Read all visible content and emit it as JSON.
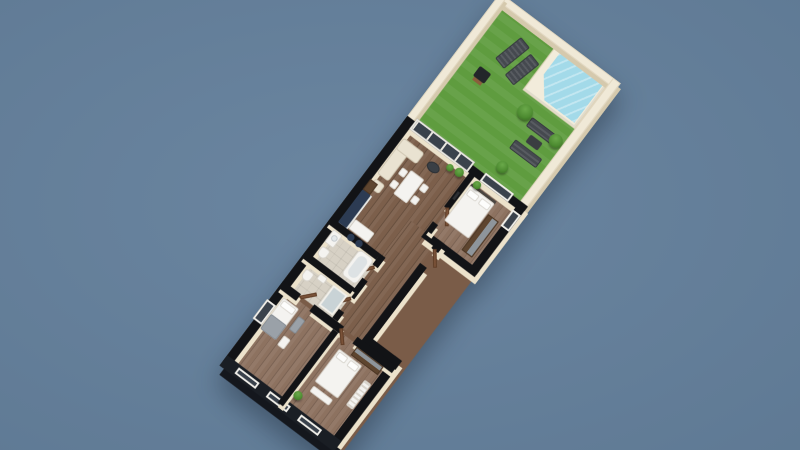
{
  "scene": {
    "type": "3d-floor-plan-render",
    "description": "Top-down 3D render of a long narrow apartment rotated diagonally on a slate-blue background, with a walled roof garden, lawn and plunge pool at the upper-right end and bedrooms at the lower-left end",
    "rotation_degrees": 37,
    "text_visible": ""
  },
  "colors": {
    "background": "#64809c",
    "wall_top": "#121316",
    "wall_face": "#ece2cb",
    "garden_wall": "#f0e9d7",
    "facade_dark": "#1a1e24",
    "floor_wood": "#7c5f4b",
    "floor_wood_light": "#8d7260",
    "floor_tile": "#d7d1c5",
    "grass": "#5f9c3f",
    "pool_water": "#a3dae9",
    "pool_deck": "#f2ecdb",
    "sofa_cream": "#e9e2d1",
    "furniture_white": "#f4f3f0",
    "kitchen_navy": "#2c3b53",
    "wood_dark": "#5e452f",
    "door_wood": "#7a5238",
    "glass_dark": "#3a424c",
    "outdoor_gray": "#45494f",
    "plant_green": "#4c8a30",
    "metal_gray": "#9aa1a8"
  },
  "rooms": [
    {
      "name": "garden-terrace",
      "features": [
        "lawn",
        "plunge pool with angled corner and cream deck",
        "2 sun loungers",
        "barbecue",
        "outdoor lounge set of 2 sofas and table",
        "3 bushes",
        "cream perimeter wall"
      ]
    },
    {
      "name": "living-dining-room",
      "features": [
        "L-shaped cream sofa",
        "white dining table with 4 chairs",
        "round dark coffee table",
        "2 potted plants",
        "wood shelf",
        "sliding glass doors to garden"
      ]
    },
    {
      "name": "kitchen",
      "features": [
        "navy cabinet run",
        "white peninsula counter",
        "2 bar stools"
      ]
    },
    {
      "name": "main-bedroom",
      "features": [
        "double bed with white duvet and 2 pillows",
        "dark wardrobe",
        "potted plant",
        "window to garden",
        "side window"
      ]
    },
    {
      "name": "bathroom-1",
      "features": [
        "bathtub",
        "vanity with basin",
        "toilet"
      ]
    },
    {
      "name": "bathroom-2",
      "features": [
        "glass shower",
        "toilet",
        "sink"
      ]
    },
    {
      "name": "hallway",
      "features": [
        "entry door",
        "wooden interior doors"
      ]
    },
    {
      "name": "bedroom-2",
      "features": [
        "single bed with gray blanket",
        "gray bench",
        "dresser",
        "window on facade"
      ]
    },
    {
      "name": "bedroom-3",
      "features": [
        "double bed",
        "dark wardrobe",
        "white radiator",
        "white bench",
        "potted plant"
      ]
    }
  ],
  "counts": {
    "bedrooms": 3,
    "bathrooms": 2,
    "sun_loungers": 2,
    "bar_stools": 2,
    "dining_chairs": 4,
    "outdoor_sofas": 2,
    "pools": 1
  },
  "exterior": {
    "end_facade": "dark with 3 white-framed windows",
    "side_windows": "dark glass with white frames"
  }
}
